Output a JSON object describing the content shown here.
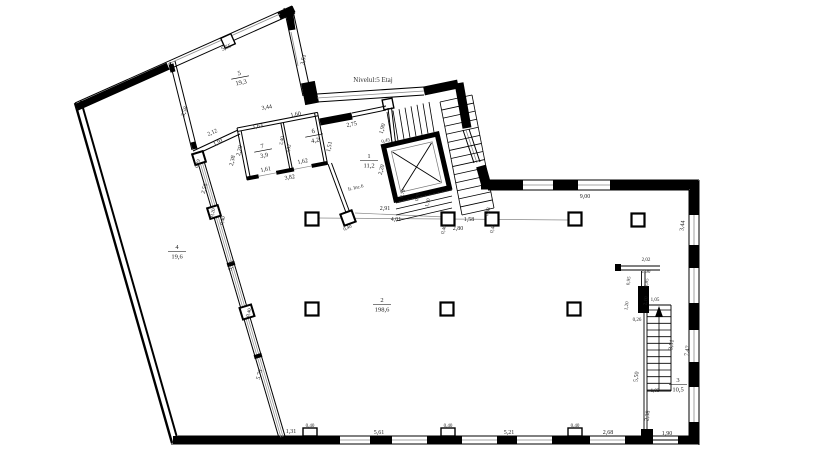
{
  "plan": {
    "title": "Nivelul:5 Etaj",
    "colors": {
      "walls": "#000000",
      "windows": "#8a8a8a",
      "labels": "#222222",
      "background": "#ffffff"
    },
    "rooms": [
      {
        "num": "5",
        "area": "19,3",
        "x": 240,
        "y": 77,
        "r": -11
      },
      {
        "num": "7",
        "area": "3,9",
        "x": 263,
        "y": 150,
        "r": -11
      },
      {
        "num": "6",
        "area": "4,2",
        "x": 314,
        "y": 135,
        "r": -11
      },
      {
        "num": "1",
        "area": "11,2",
        "x": 369,
        "y": 160,
        "r": 0
      },
      {
        "num": "2",
        "area": "198,6",
        "x": 382,
        "y": 304,
        "r": 0
      },
      {
        "num": "4",
        "area": "19,6",
        "x": 177,
        "y": 251,
        "r": 0
      },
      {
        "num": "3",
        "area": "10,5",
        "x": 678,
        "y": 384,
        "r": 0
      }
    ],
    "annotations": [
      {
        "t": "It. Inc.6",
        "x": 356,
        "y": 189,
        "r": -13,
        "s": 5
      }
    ],
    "dimensions": [
      {
        "t": "5,55",
        "x": 227,
        "y": 49,
        "r": -24
      },
      {
        "t": "3,51",
        "x": 305,
        "y": 60,
        "r": -78
      },
      {
        "t": "3,58",
        "x": 186,
        "y": 112,
        "r": -72
      },
      {
        "t": "2,12",
        "x": 213,
        "y": 134,
        "r": -24
      },
      {
        "t": "1,91",
        "x": 219,
        "y": 144,
        "r": -24
      },
      {
        "t": "3,44",
        "x": 267,
        "y": 109,
        "r": -11
      },
      {
        "t": "1,63",
        "x": 258,
        "y": 128,
        "r": -11
      },
      {
        "t": "1,60",
        "x": 296,
        "y": 116,
        "r": -11
      },
      {
        "t": "2,75",
        "x": 352,
        "y": 126,
        "r": -11
      },
      {
        "t": "2,20",
        "x": 241,
        "y": 151,
        "r": -78
      },
      {
        "t": "2,38",
        "x": 234,
        "y": 161,
        "r": -78
      },
      {
        "t": "2,40",
        "x": 283,
        "y": 141,
        "r": -78,
        "s": 5
      },
      {
        "t": "2,52",
        "x": 290,
        "y": 149,
        "r": -78,
        "s": 5
      },
      {
        "t": "1,51",
        "x": 331,
        "y": 147,
        "r": -78
      },
      {
        "t": "1,61",
        "x": 266,
        "y": 171,
        "r": -11
      },
      {
        "t": "1,62",
        "x": 303,
        "y": 163,
        "r": -11
      },
      {
        "t": "3,82",
        "x": 290,
        "y": 179,
        "r": -11
      },
      {
        "t": "1,90",
        "x": 384,
        "y": 129,
        "r": -75
      },
      {
        "t": "0,45",
        "x": 386,
        "y": 142,
        "r": -13,
        "s": 5
      },
      {
        "t": "2,20",
        "x": 383,
        "y": 170,
        "r": -75
      },
      {
        "t": "0,79",
        "x": 404,
        "y": 194,
        "r": -75,
        "s": 5
      },
      {
        "t": "0,70",
        "x": 419,
        "y": 197,
        "r": -75,
        "s": 5
      },
      {
        "t": "1,50",
        "x": 429,
        "y": 203,
        "r": -75,
        "s": 5
      },
      {
        "t": "0,40",
        "x": 348,
        "y": 229,
        "r": -24,
        "s": 5
      },
      {
        "t": "2,91",
        "x": 385,
        "y": 210,
        "r": 0
      },
      {
        "t": "4,01",
        "x": 396,
        "y": 221,
        "r": 0
      },
      {
        "t": "0,40",
        "x": 445,
        "y": 230,
        "r": -75,
        "s": 5
      },
      {
        "t": "2,80",
        "x": 458,
        "y": 230,
        "r": 0
      },
      {
        "t": "1,58",
        "x": 469,
        "y": 221,
        "r": 0
      },
      {
        "t": "0,38",
        "x": 489,
        "y": 212,
        "r": -75,
        "s": 5
      },
      {
        "t": "0,40",
        "x": 494,
        "y": 229,
        "r": -75,
        "s": 5
      },
      {
        "t": "9,00",
        "x": 585,
        "y": 198,
        "r": 0
      },
      {
        "t": "3,44",
        "x": 684,
        "y": 226,
        "r": -82
      },
      {
        "t": "2,02",
        "x": 646,
        "y": 261,
        "r": 0,
        "s": 5
      },
      {
        "t": "1,90",
        "x": 646,
        "y": 273,
        "r": 0,
        "s": 5
      },
      {
        "t": "0,95",
        "x": 630,
        "y": 281,
        "r": -82,
        "s": 5
      },
      {
        "t": "0,85",
        "x": 648,
        "y": 283,
        "r": -82,
        "s": 5
      },
      {
        "t": "1,20",
        "x": 628,
        "y": 306,
        "r": -82,
        "s": 5
      },
      {
        "t": "2,10",
        "x": 647,
        "y": 301,
        "r": -82,
        "s": 5
      },
      {
        "t": "1,05",
        "x": 655,
        "y": 301,
        "r": 0,
        "s": 5
      },
      {
        "t": "0,26",
        "x": 637,
        "y": 321,
        "r": 0,
        "s": 5
      },
      {
        "t": "3,51",
        "x": 673,
        "y": 345,
        "r": -82
      },
      {
        "t": "7,47",
        "x": 689,
        "y": 351,
        "r": -82
      },
      {
        "t": "5,50",
        "x": 638,
        "y": 377,
        "r": -82
      },
      {
        "t": "1,05",
        "x": 655,
        "y": 392,
        "r": 0,
        "s": 5
      },
      {
        "t": "2,38",
        "x": 649,
        "y": 416,
        "r": -82
      },
      {
        "t": "1,90",
        "x": 667,
        "y": 435,
        "r": 0
      },
      {
        "t": "2,68",
        "x": 608,
        "y": 434,
        "r": 0
      },
      {
        "t": "0,40",
        "x": 575,
        "y": 427,
        "r": 0,
        "s": 5
      },
      {
        "t": "5,21",
        "x": 509,
        "y": 434,
        "r": 0
      },
      {
        "t": "0,40",
        "x": 448,
        "y": 427,
        "r": 0,
        "s": 5
      },
      {
        "t": "5,61",
        "x": 379,
        "y": 434,
        "r": 0
      },
      {
        "t": "0,40",
        "x": 310,
        "y": 427,
        "r": 0,
        "s": 5
      },
      {
        "t": "1,31",
        "x": 291,
        "y": 433,
        "r": 0
      },
      {
        "t": "5,73",
        "x": 261,
        "y": 375,
        "r": -73
      },
      {
        "t": "0,40",
        "x": 250,
        "y": 313,
        "r": -73,
        "s": 5
      },
      {
        "t": "3,76",
        "x": 233,
        "y": 266,
        "r": -73
      },
      {
        "t": "0,40",
        "x": 224,
        "y": 221,
        "r": -73,
        "s": 5
      },
      {
        "t": "0,20",
        "x": 214,
        "y": 213,
        "r": -73,
        "s": 5
      },
      {
        "t": "2,56",
        "x": 206,
        "y": 189,
        "r": -73
      },
      {
        "t": "0,19",
        "x": 199,
        "y": 164,
        "r": -73,
        "s": 5
      }
    ]
  }
}
